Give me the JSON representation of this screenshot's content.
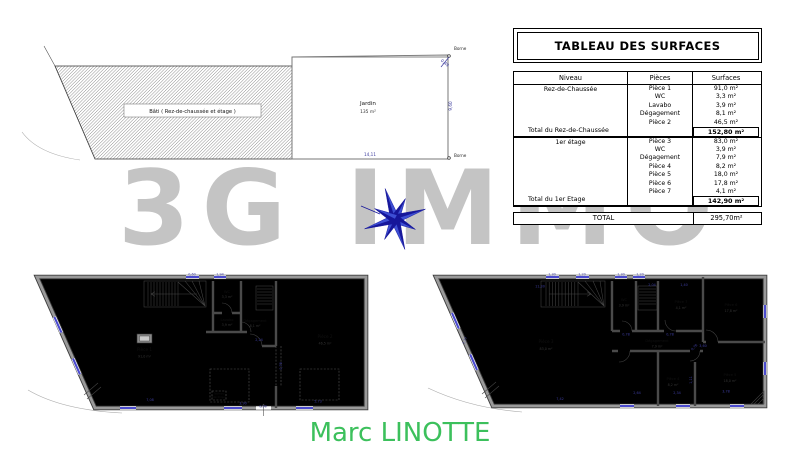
{
  "watermark": {
    "text": "3G IMMO",
    "color": "#c4c4c4"
  },
  "footer": {
    "agent_name": "Marc LINOTTE",
    "color": "#3cc05c"
  },
  "colors": {
    "dimension_blue": "#3c3c9e",
    "window_blue": "#4a4ace",
    "compass_navy": "#16169a",
    "compass_royal": "#3d4fd4"
  },
  "site_plan": {
    "bati_label": "Bâti ( Rez-de-chaussée et étage )",
    "jardin_label": "Jardin",
    "jardin_area": "135 m²",
    "borne_top": "Borne",
    "borne_bottom": "Borne",
    "dims": [
      {
        "t": "14,11",
        "x": 370,
        "y": 156
      },
      {
        "t": "9,60",
        "x": 452,
        "y": 106,
        "r": -90
      },
      {
        "t": "0,49",
        "x": 444,
        "y": 64,
        "r": 40
      }
    ]
  },
  "surface_table": {
    "title": "TABLEAU DES SURFACES",
    "headers": [
      "Niveau",
      "Pièces",
      "Surfaces"
    ],
    "groups": [
      {
        "level": "Rez-de-Chaussée",
        "rows": [
          [
            "Pièce 1",
            "91,0 m²"
          ],
          [
            "WC",
            "3,3 m²"
          ],
          [
            "Lavabo",
            "3,9 m²"
          ],
          [
            "Dégagement",
            "8,1 m²"
          ],
          [
            "Pièce 2",
            "46,5 m²"
          ]
        ],
        "total_label": "Total du Rez-de-Chaussée",
        "total_value": "152,80 m²"
      },
      {
        "level": "1er étage",
        "rows": [
          [
            "Pièce 3",
            "83,0 m²"
          ],
          [
            "WC",
            "3,9 m²"
          ],
          [
            "Dégagement",
            "7,9 m²"
          ],
          [
            "Pièce 4",
            "8,2 m²"
          ],
          [
            "Pièce 5",
            "18,0 m²"
          ],
          [
            "Pièce 6",
            "17,8 m²"
          ],
          [
            "Pièce 7",
            "4,1 m²"
          ]
        ],
        "total_label": "Total du 1er Etage",
        "total_value": "142,90 m²"
      }
    ],
    "total_label": "TOTAL",
    "total_value": "295,70m²"
  },
  "plans": {
    "rdc": {
      "rooms": [
        {
          "name": "Pièce 1",
          "area": "91,0 m²"
        },
        {
          "name": "WC",
          "area": "3,3 m²"
        },
        {
          "name": "Lavabo",
          "area": "3,9 m²"
        },
        {
          "name": "Dégagement",
          "area": "8,1 m²"
        },
        {
          "name": "Pièce 2",
          "area": "46,5 m²"
        }
      ],
      "tableau_line1": "Tableau",
      "tableau_line2": "électrique",
      "dims": [
        {
          "t": "0,60",
          "x": 192,
          "y": 275.5
        },
        {
          "t": "1,94",
          "x": 220,
          "y": 275.5
        },
        {
          "t": "7,08",
          "x": 150,
          "y": 401
        },
        {
          "t": "3,90",
          "x": 243,
          "y": 404.5
        },
        {
          "t": "0,90",
          "x": 263,
          "y": 407.5
        },
        {
          "t": "5,73",
          "x": 318,
          "y": 402.5
        },
        {
          "t": "2,24",
          "x": 259,
          "y": 341
        },
        {
          "t": "0,78",
          "x": 282,
          "y": 366,
          "r": -90
        }
      ]
    },
    "etage": {
      "rooms": [
        {
          "name": "Pièce 3",
          "area": "83,0 m²"
        },
        {
          "name": "WC",
          "area": "3,9 m²"
        },
        {
          "name": "Dégagement",
          "area": "7,9 m²"
        },
        {
          "name": "Pièce 4",
          "area": "8,2 m²"
        },
        {
          "name": "Pièce 5",
          "area": "18,0 m²"
        },
        {
          "name": "Pièce 6",
          "area": "17,8 m²"
        },
        {
          "name": "Pièce 7",
          "area": "4,1 m²"
        }
      ],
      "dims": [
        {
          "t": "11,30",
          "x": 540,
          "y": 287.5
        },
        {
          "t": "1,30",
          "x": 552,
          "y": 275.5
        },
        {
          "t": "1,20",
          "x": 582,
          "y": 275.5
        },
        {
          "t": "1,30",
          "x": 621,
          "y": 275.5
        },
        {
          "t": "1,20",
          "x": 640,
          "y": 275.5
        },
        {
          "t": "2,04",
          "x": 652,
          "y": 286
        },
        {
          "t": "1,40",
          "x": 684,
          "y": 286
        },
        {
          "t": "0,78",
          "x": 626,
          "y": 335.5
        },
        {
          "t": "0,78",
          "x": 670,
          "y": 335.5
        },
        {
          "t": "0,78",
          "x": 695,
          "y": 348,
          "r": -45
        },
        {
          "t": "3,60",
          "x": 703,
          "y": 347
        },
        {
          "t": "1,11",
          "x": 692,
          "y": 380,
          "r": -90
        },
        {
          "t": "2,64",
          "x": 637,
          "y": 394
        },
        {
          "t": "2,34",
          "x": 677,
          "y": 394
        },
        {
          "t": "3,78",
          "x": 726,
          "y": 392.5
        },
        {
          "t": "7,42",
          "x": 560,
          "y": 400
        },
        {
          "t": "7,77",
          "x": 466,
          "y": 341,
          "r": -68
        }
      ]
    }
  }
}
